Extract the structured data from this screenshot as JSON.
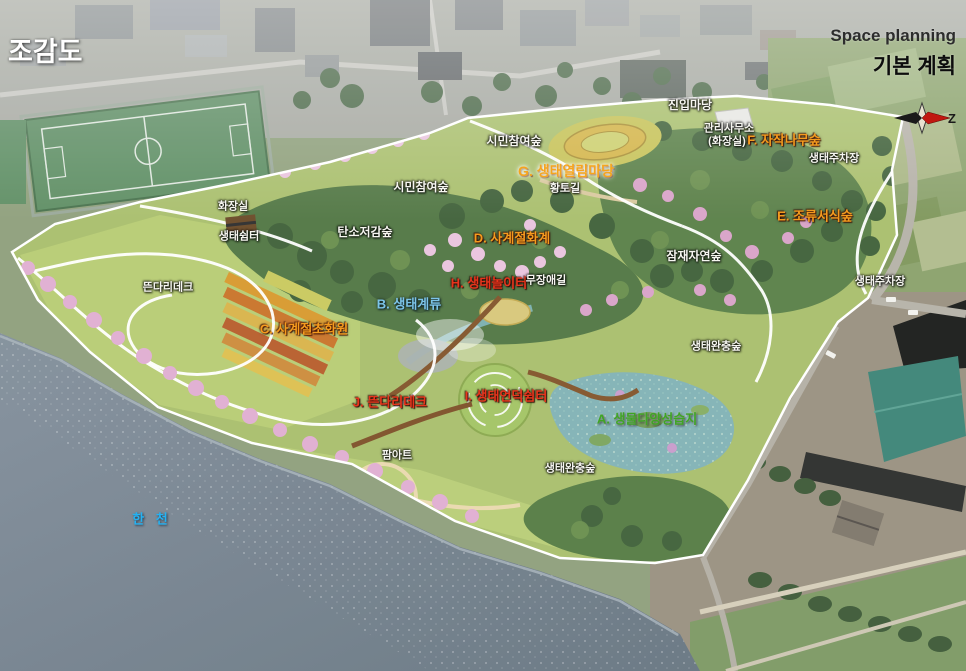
{
  "header": {
    "title": "조감도",
    "plan_label_en": "Space planning",
    "plan_label_ko": "기본 계획",
    "compass_letter": "Z"
  },
  "map_labels": [
    {
      "text": "진입마당",
      "color": "white",
      "x": 690,
      "y": 105,
      "size": 12
    },
    {
      "text": "시민참여숲",
      "color": "white",
      "x": 514,
      "y": 141,
      "size": 12
    },
    {
      "text": "관리사무소",
      "color": "white",
      "x": 729,
      "y": 129,
      "size": 11
    },
    {
      "text": "(화장실)",
      "color": "white",
      "x": 727,
      "y": 142,
      "size": 11
    },
    {
      "text": "F. 자작나무숲",
      "color": "orange",
      "x": 784,
      "y": 140,
      "size": 13
    },
    {
      "text": "생태주차장",
      "color": "white",
      "x": 834,
      "y": 159,
      "size": 11
    },
    {
      "text": "G. 생태열림마당",
      "color": "glow",
      "x": 566,
      "y": 171,
      "size": 14
    },
    {
      "text": "황토길",
      "color": "white",
      "x": 565,
      "y": 189,
      "size": 11
    },
    {
      "text": "E. 조류서식숲",
      "color": "orange",
      "x": 815,
      "y": 216,
      "size": 13
    },
    {
      "text": "화장실",
      "color": "white",
      "x": 233,
      "y": 207,
      "size": 11
    },
    {
      "text": "생태쉼터",
      "color": "white",
      "x": 239,
      "y": 237,
      "size": 11
    },
    {
      "text": "시민참여숲",
      "color": "white",
      "x": 421,
      "y": 187,
      "size": 12
    },
    {
      "text": "탄소저감숲",
      "color": "white",
      "x": 365,
      "y": 232,
      "size": 12
    },
    {
      "text": "D. 사계절화계",
      "color": "orange",
      "x": 512,
      "y": 238,
      "size": 13
    },
    {
      "text": "잠재자연숲",
      "color": "white",
      "x": 694,
      "y": 256,
      "size": 12
    },
    {
      "text": "H. 생태놀이터",
      "color": "red",
      "x": 489,
      "y": 283,
      "size": 13
    },
    {
      "text": "무장애길",
      "color": "white",
      "x": 546,
      "y": 281,
      "size": 11
    },
    {
      "text": "생태주차장",
      "color": "white",
      "x": 880,
      "y": 282,
      "size": 11
    },
    {
      "text": "뜬다리데크",
      "color": "white",
      "x": 168,
      "y": 288,
      "size": 11
    },
    {
      "text": "B. 생태계류",
      "color": "blue",
      "x": 409,
      "y": 304,
      "size": 13
    },
    {
      "text": "C. 사계절초화원",
      "color": "orange",
      "x": 304,
      "y": 329,
      "size": 13
    },
    {
      "text": "생태완충숲",
      "color": "white",
      "x": 716,
      "y": 347,
      "size": 11
    },
    {
      "text": "I. 생태언덕쉼터",
      "color": "red",
      "x": 506,
      "y": 396,
      "size": 13
    },
    {
      "text": "J. 뜬다리데크",
      "color": "red",
      "x": 390,
      "y": 402,
      "size": 13
    },
    {
      "text": "A. 생물다양성습지",
      "color": "green",
      "x": 647,
      "y": 419,
      "size": 13
    },
    {
      "text": "팜아트",
      "color": "white",
      "x": 397,
      "y": 456,
      "size": 11
    },
    {
      "text": "생태완충숲",
      "color": "white",
      "x": 570,
      "y": 469,
      "size": 11
    },
    {
      "text": "한 천",
      "color": "cyan",
      "x": 152,
      "y": 519,
      "size": 13
    }
  ],
  "colors": {
    "label_white": "#f6f6f0",
    "label_orange": "#f59b1e",
    "label_red": "#e8341c",
    "label_blue": "#7cc4e8",
    "label_green": "#3fa524",
    "river_label": "#25b2f2",
    "compass_red": "#c01810",
    "compass_black": "#1a1a1a"
  }
}
